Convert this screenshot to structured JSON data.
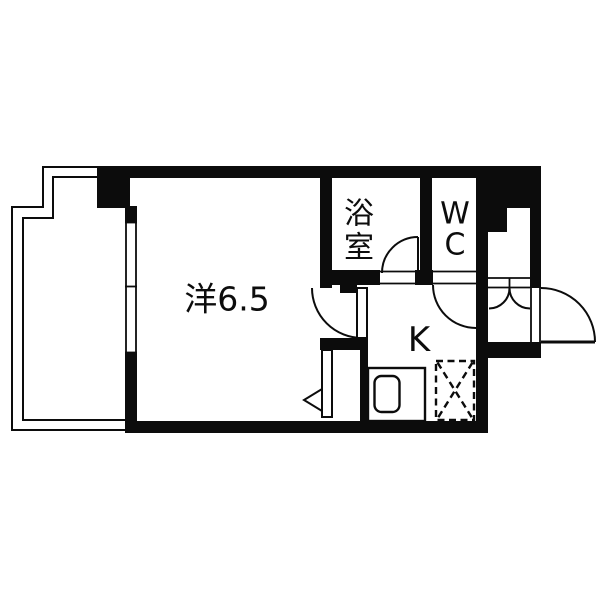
{
  "figure": {
    "type": "apartment-floor-plan",
    "background": "#ffffff",
    "wall_color": "#0c0c0c"
  },
  "rooms": {
    "main": {
      "label": "洋6.5"
    },
    "bath": {
      "label": "浴室",
      "char1": "浴",
      "char2": "室"
    },
    "wc": {
      "label": "WC",
      "char1": "W",
      "char2": "C"
    },
    "kitchen": {
      "label": "K"
    }
  },
  "features": {
    "balcony": "balcony-outline",
    "entrance_door": "entrance-swing-door",
    "washer_pan": "washing-machine-space-dashed-x",
    "kitchen_sink": "sink-counter",
    "closet": "closet-with-left-opening-door",
    "shoe_cabinet": "double-door-cabinet",
    "pipe_space": "solid-black-shaft"
  }
}
